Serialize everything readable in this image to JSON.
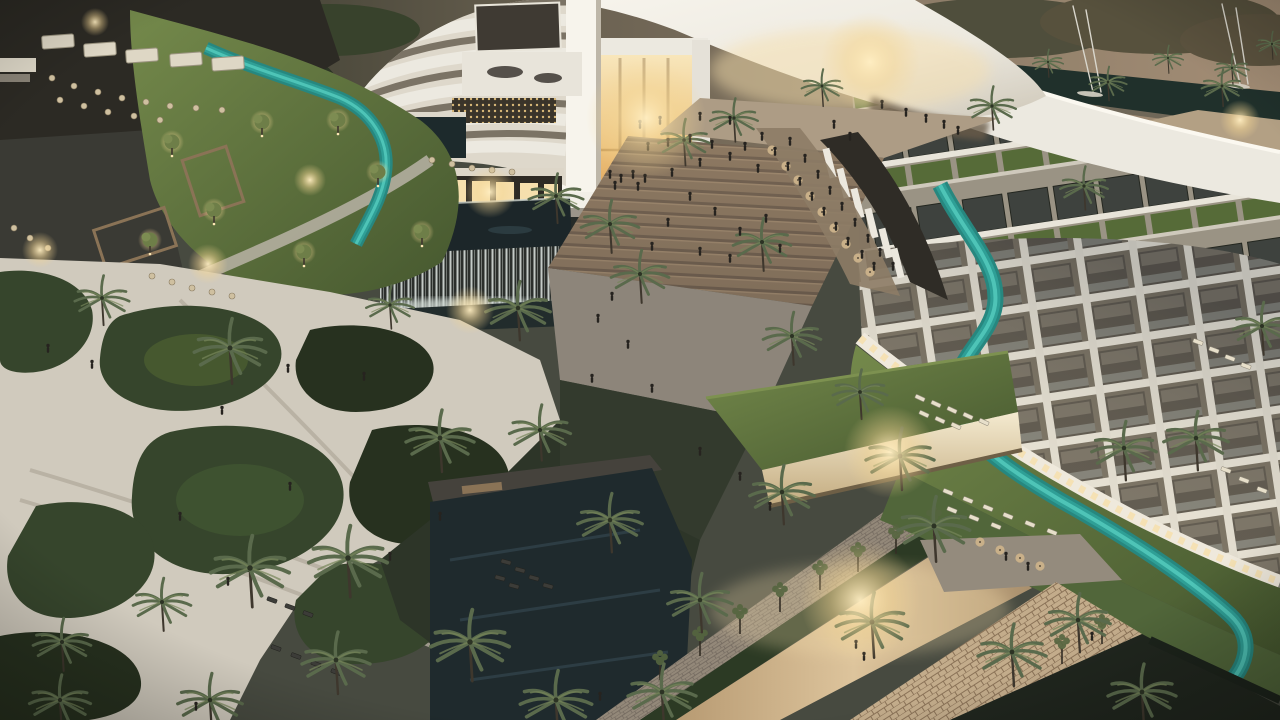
{
  "meta": {
    "type": "architectural-rendering",
    "subject": "aerial dusk view of a luxury resort: curved white hotel wings with balconies and green solar roofs, glowing central atrium with grand steps, winding teal lazy river, waterfall feature, ornamental gardens, pools and palm-lined promenades, marina with sailboats in background",
    "time_of_day": "dusk"
  },
  "palette": {
    "sky_left": "#262b20",
    "sky_mid": "#6b6252",
    "sky_right": "#a18b74",
    "backdrop_foliage": "#2e3526",
    "marina_water": "#20302b",
    "mast": "#d9d6cc",
    "white": "#ece9e0",
    "white_bright": "#f7f4ec",
    "white_dim": "#cfc8b9",
    "recess": "#5c564c",
    "slab": "#e9e5da",
    "green_roof": "#566b38",
    "solar": "#3e423e",
    "roof_base": "#9a9384",
    "canopy_tan": "#b3a084",
    "glow": "#f6dfad",
    "glow_deep": "#e2a95f",
    "steps": "#8d7962",
    "steps_dark": "#67584a",
    "plaza": "#ad9c85",
    "sand": "#d0cabd",
    "sand_dark": "#b4ad9f",
    "path_light": "#b9b3a6",
    "lawn": "#5d7342",
    "lawn_dark": "#46582f",
    "lawn_lit": "#74894b",
    "shrub": "#36452c",
    "shrub_dark": "#27311f",
    "palm_frond": "#5a6a4c",
    "palm_frond_dark": "#4a5440",
    "palm_trunk": "#3e372d",
    "river": "#2f9f96",
    "river_bright": "#52c8ba",
    "pool": "#1f2a2d",
    "deck": "#45423c",
    "stone_dark": "#3f423c",
    "warm_light": "#f6dca2",
    "promenade": "#d2b88e",
    "people_dark": "#26231f",
    "umbrella": "#c9b089",
    "lounger": "#e7dfca",
    "brick": "#938879",
    "flagstone": "#c3ac8b",
    "hedge": "#2c3a24"
  },
  "scene": {
    "palms_bg": [
      [
        28,
        42,
        0.5,
        2
      ],
      [
        88,
        52,
        0.55,
        2
      ],
      [
        148,
        88,
        0.5,
        2
      ],
      [
        205,
        20,
        0.45,
        2
      ],
      [
        282,
        38,
        0.5,
        2
      ],
      [
        988,
        78,
        0.5,
        2
      ],
      [
        1048,
        62,
        0.45,
        2
      ],
      [
        1108,
        82,
        0.55,
        2
      ],
      [
        1168,
        58,
        0.45,
        2
      ],
      [
        1232,
        68,
        0.5,
        2
      ],
      [
        1272,
        44,
        0.45,
        2
      ],
      [
        1222,
        86,
        0.6,
        2
      ]
    ],
    "palms": [
      [
        102,
        298,
        0.8,
        1
      ],
      [
        230,
        348,
        1.05,
        1
      ],
      [
        250,
        568,
        1.15,
        1
      ],
      [
        348,
        558,
        1.15,
        1
      ],
      [
        440,
        438,
        1.0,
        1
      ],
      [
        518,
        308,
        0.95,
        1
      ],
      [
        556,
        196,
        0.8,
        1
      ],
      [
        610,
        224,
        0.85,
        1
      ],
      [
        640,
        274,
        0.85,
        1
      ],
      [
        684,
        140,
        0.75,
        1
      ],
      [
        734,
        118,
        0.7,
        1
      ],
      [
        762,
        242,
        0.85,
        1
      ],
      [
        792,
        336,
        0.85,
        1
      ],
      [
        822,
        86,
        0.6,
        1
      ],
      [
        900,
        456,
        1.0,
        1
      ],
      [
        934,
        526,
        1.05,
        1
      ],
      [
        992,
        106,
        0.7,
        1
      ],
      [
        1084,
        186,
        0.7,
        1
      ],
      [
        1124,
        448,
        0.95,
        1
      ],
      [
        1196,
        438,
        0.95,
        1
      ],
      [
        1262,
        326,
        0.85,
        1
      ],
      [
        470,
        642,
        1.15,
        1
      ],
      [
        556,
        700,
        1.05,
        1
      ],
      [
        662,
        692,
        1.0,
        1
      ],
      [
        782,
        492,
        0.95,
        1
      ],
      [
        860,
        392,
        0.8,
        1
      ],
      [
        872,
        622,
        1.05,
        1
      ],
      [
        1012,
        652,
        1.0,
        1
      ],
      [
        1142,
        692,
        1.0,
        1
      ],
      [
        62,
        642,
        0.85,
        1
      ],
      [
        162,
        602,
        0.85,
        1
      ],
      [
        336,
        660,
        1.0,
        1
      ],
      [
        390,
        305,
        0.7,
        1
      ],
      [
        540,
        430,
        0.9,
        1
      ],
      [
        610,
        520,
        0.95,
        1
      ],
      [
        700,
        600,
        0.95,
        1
      ],
      [
        1078,
        620,
        0.95,
        1
      ],
      [
        60,
        700,
        0.9,
        1
      ],
      [
        210,
        700,
        0.95,
        1
      ]
    ],
    "people": [
      [
        648,
        150
      ],
      [
        668,
        146
      ],
      [
        690,
        142
      ],
      [
        712,
        148
      ],
      [
        700,
        166
      ],
      [
        672,
        176
      ],
      [
        730,
        160
      ],
      [
        745,
        150
      ],
      [
        758,
        172
      ],
      [
        690,
        200
      ],
      [
        715,
        215
      ],
      [
        668,
        226
      ],
      [
        740,
        235
      ],
      [
        766,
        222
      ],
      [
        700,
        255
      ],
      [
        652,
        250
      ],
      [
        730,
        262
      ],
      [
        780,
        252
      ],
      [
        640,
        128
      ],
      [
        660,
        124
      ],
      [
        700,
        120
      ],
      [
        730,
        124
      ],
      [
        834,
        128
      ],
      [
        850,
        140
      ],
      [
        882,
        108
      ],
      [
        906,
        116
      ],
      [
        926,
        122
      ],
      [
        944,
        128
      ],
      [
        958,
        134
      ],
      [
        762,
        140
      ],
      [
        775,
        155
      ],
      [
        788,
        170
      ],
      [
        800,
        185
      ],
      [
        812,
        200
      ],
      [
        824,
        215
      ],
      [
        836,
        230
      ],
      [
        848,
        245
      ],
      [
        862,
        258
      ],
      [
        874,
        270
      ],
      [
        790,
        145
      ],
      [
        805,
        162
      ],
      [
        818,
        178
      ],
      [
        830,
        194
      ],
      [
        842,
        210
      ],
      [
        855,
        226
      ],
      [
        868,
        242
      ],
      [
        880,
        256
      ],
      [
        893,
        270
      ],
      [
        610,
        178
      ],
      [
        621,
        182
      ],
      [
        633,
        178
      ],
      [
        645,
        182
      ],
      [
        615,
        189
      ],
      [
        638,
        190
      ],
      [
        598,
        322
      ],
      [
        628,
        348
      ],
      [
        592,
        382
      ],
      [
        652,
        392
      ],
      [
        612,
        300
      ],
      [
        48,
        352
      ],
      [
        92,
        368
      ],
      [
        288,
        372
      ],
      [
        364,
        380
      ],
      [
        290,
        490
      ],
      [
        222,
        414
      ],
      [
        440,
        520
      ],
      [
        390,
        560
      ],
      [
        180,
        520
      ],
      [
        228,
        585
      ],
      [
        196,
        710
      ],
      [
        600,
        700
      ],
      [
        856,
        648
      ],
      [
        864,
        660
      ],
      [
        740,
        480
      ],
      [
        700,
        455
      ],
      [
        770,
        510
      ],
      [
        1006,
        560
      ],
      [
        1028,
        570
      ],
      [
        1092,
        640
      ]
    ],
    "loungers": [
      [
        920,
        398,
        25,
        1
      ],
      [
        936,
        404,
        25,
        1
      ],
      [
        952,
        410,
        25,
        1
      ],
      [
        968,
        416,
        25,
        1
      ],
      [
        984,
        422,
        25,
        1
      ],
      [
        924,
        414,
        25,
        1
      ],
      [
        940,
        420,
        25,
        1
      ],
      [
        956,
        426,
        25,
        1
      ],
      [
        948,
        492,
        22,
        1
      ],
      [
        968,
        500,
        22,
        1
      ],
      [
        988,
        508,
        22,
        1
      ],
      [
        1008,
        516,
        22,
        1
      ],
      [
        1030,
        524,
        22,
        1
      ],
      [
        1052,
        532,
        22,
        1
      ],
      [
        952,
        510,
        22,
        1
      ],
      [
        974,
        518,
        22,
        1
      ],
      [
        996,
        526,
        22,
        1
      ],
      [
        1198,
        342,
        20,
        1
      ],
      [
        1214,
        350,
        20,
        1
      ],
      [
        1230,
        358,
        20,
        1
      ],
      [
        1246,
        366,
        20,
        1
      ],
      [
        1226,
        470,
        20,
        1
      ],
      [
        1244,
        480,
        20,
        1
      ],
      [
        1262,
        490,
        20,
        1
      ],
      [
        506,
        562,
        15,
        2
      ],
      [
        520,
        570,
        15,
        2
      ],
      [
        534,
        578,
        15,
        2
      ],
      [
        548,
        586,
        15,
        2
      ],
      [
        500,
        578,
        15,
        2
      ],
      [
        514,
        586,
        15,
        2
      ],
      [
        272,
        600,
        20,
        2
      ],
      [
        290,
        607,
        20,
        2
      ],
      [
        308,
        614,
        20,
        2
      ],
      [
        276,
        648,
        20,
        2
      ],
      [
        296,
        656,
        20,
        2
      ],
      [
        316,
        664,
        20,
        2
      ],
      [
        336,
        672,
        20,
        2
      ]
    ],
    "tables": [
      [
        52,
        78,
        1
      ],
      [
        74,
        86,
        1
      ],
      [
        98,
        92,
        1
      ],
      [
        122,
        98,
        1
      ],
      [
        146,
        102,
        1
      ],
      [
        170,
        106,
        1
      ],
      [
        196,
        108,
        1
      ],
      [
        222,
        110,
        1
      ],
      [
        60,
        100,
        1
      ],
      [
        84,
        106,
        1
      ],
      [
        108,
        112,
        1
      ],
      [
        134,
        116,
        1
      ],
      [
        160,
        120,
        1
      ],
      [
        152,
        276,
        1
      ],
      [
        172,
        282,
        1
      ],
      [
        192,
        288,
        1
      ],
      [
        212,
        292,
        1
      ],
      [
        232,
        296,
        1
      ],
      [
        14,
        228,
        1
      ],
      [
        30,
        238,
        1
      ],
      [
        48,
        248,
        1
      ],
      [
        432,
        160,
        1
      ],
      [
        452,
        164,
        1
      ],
      [
        472,
        168,
        1
      ],
      [
        492,
        170,
        1
      ],
      [
        512,
        172,
        1
      ],
      [
        772,
        150,
        2
      ],
      [
        786,
        166,
        2
      ],
      [
        798,
        180,
        2
      ],
      [
        810,
        196,
        2
      ],
      [
        822,
        212,
        2
      ],
      [
        834,
        228,
        2
      ],
      [
        846,
        244,
        2
      ],
      [
        858,
        258,
        2
      ],
      [
        870,
        272,
        2
      ],
      [
        1000,
        550,
        2
      ],
      [
        1020,
        558,
        2
      ],
      [
        1040,
        566,
        2
      ],
      [
        980,
        542,
        2
      ]
    ],
    "masts": [
      [
        1093,
        92,
        1073,
        6
      ],
      [
        1101,
        92,
        1086,
        10
      ],
      [
        1240,
        84,
        1222,
        4
      ],
      [
        1248,
        84,
        1236,
        8
      ]
    ],
    "lit_trees": [
      [
        172,
        142
      ],
      [
        214,
        210
      ],
      [
        262,
        122
      ],
      [
        304,
        252
      ],
      [
        338,
        120
      ],
      [
        378,
        172
      ],
      [
        422,
        232
      ],
      [
        150,
        240
      ]
    ],
    "promenade_trees": [
      [
        700,
        640
      ],
      [
        740,
        618
      ],
      [
        780,
        596
      ],
      [
        820,
        574
      ],
      [
        858,
        556
      ],
      [
        896,
        538
      ],
      [
        660,
        664
      ],
      [
        934,
        520
      ],
      [
        1062,
        648
      ],
      [
        1102,
        628
      ]
    ],
    "canopies": [
      [
        58,
        42
      ],
      [
        100,
        50
      ],
      [
        142,
        56
      ],
      [
        186,
        60
      ],
      [
        228,
        64
      ]
    ],
    "glow_lights": [
      [
        95,
        22,
        14
      ],
      [
        646,
        118,
        60
      ],
      [
        870,
        62,
        50
      ],
      [
        490,
        192,
        26
      ],
      [
        890,
        452,
        46
      ],
      [
        860,
        600,
        60
      ],
      [
        470,
        310,
        24
      ],
      [
        1240,
        120,
        20
      ],
      [
        40,
        250,
        18
      ],
      [
        208,
        264,
        20
      ],
      [
        310,
        180,
        16
      ]
    ]
  }
}
